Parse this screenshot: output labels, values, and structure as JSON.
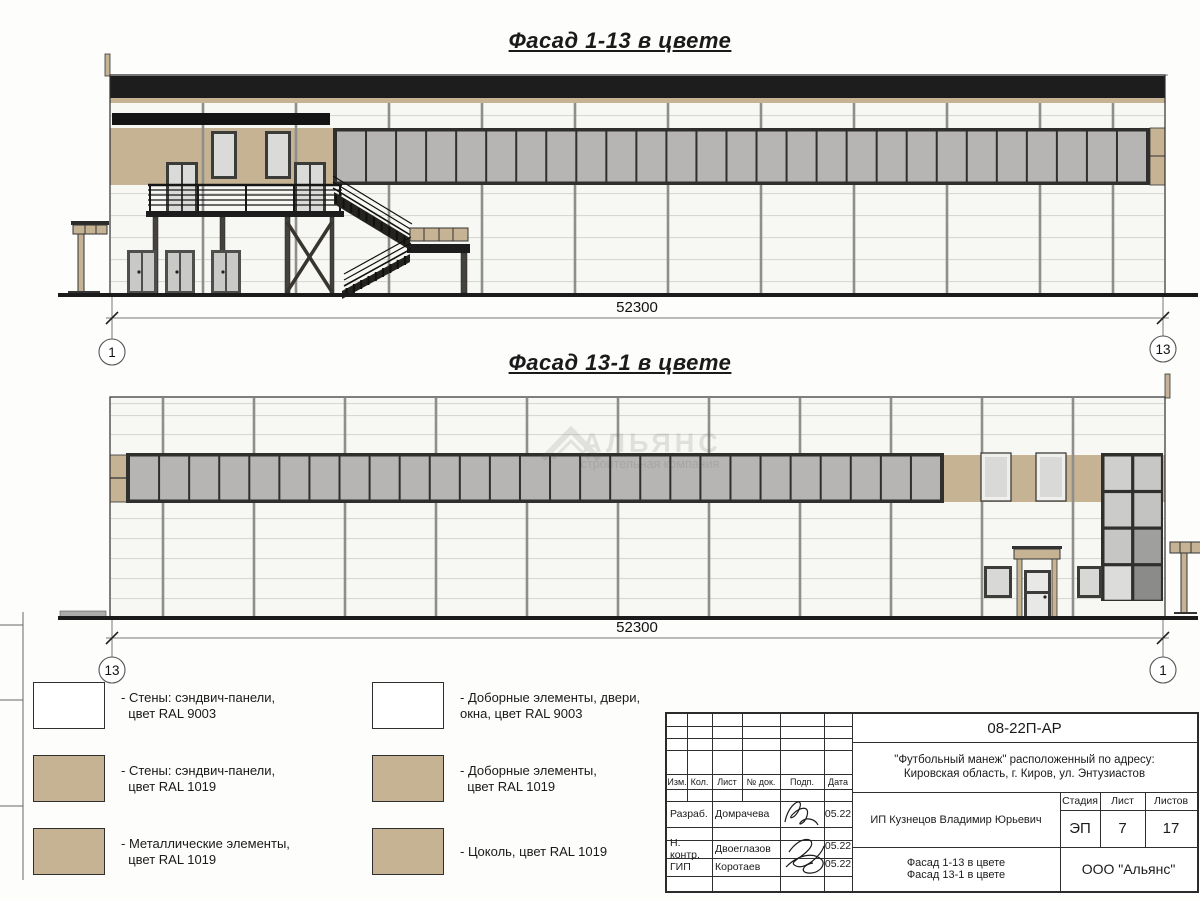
{
  "colors": {
    "tan": "#c5b394",
    "dark_band": "#1d1d1d",
    "frame": "#2f2f2d",
    "glass": "#b6b5b3",
    "panel": "#f7f7f4",
    "joint_h": "#d8d8d3",
    "joint_v": "#8f8e8a",
    "light_glass": "#dadad8",
    "grid_shades": [
      [
        "#cfcfcd",
        "#c7c7c5"
      ],
      [
        "#cbcbc9",
        "#c3c3c1"
      ],
      [
        "#c6c6c4",
        "#9f9f9d"
      ],
      [
        "#dcdcda",
        "#8b8b89"
      ]
    ]
  },
  "facade1": {
    "title": "Фасад 1-13 в цвете",
    "dimension": "52300",
    "axis_left": "1",
    "axis_right": "13",
    "ribbon_panes": 27
  },
  "facade2": {
    "title": "Фасад 13-1 в цвете",
    "dimension": "52300",
    "axis_left": "13",
    "axis_right": "1",
    "ribbon_panes": 27
  },
  "watermark": {
    "name": "АЛЬЯНС",
    "tagline": "строительная компания"
  },
  "legend": {
    "col1": [
      {
        "color": "#ffffff",
        "label": "- Стены: сэндвич-панели,\n  цвет RAL 9003"
      },
      {
        "color": "#c5b394",
        "label": "- Стены: сэндвич-панели,\n  цвет RAL 1019"
      },
      {
        "color": "#c5b394",
        "label": "- Металлические элементы,\n  цвет RAL 1019"
      }
    ],
    "col2": [
      {
        "color": "#ffffff",
        "label": "- Доборные элементы, двери,\nокна, цвет RAL 9003"
      },
      {
        "color": "#c5b394",
        "label": "- Доборные элементы,\n  цвет RAL 1019"
      },
      {
        "color": "#c5b394",
        "label": "- Цоколь, цвет RAL 1019"
      }
    ]
  },
  "title_block": {
    "doc_number": "08-22П-АР",
    "project": "\"Футбольный манеж\" расположенный по адресу:\nКировская область, г. Киров, ул. Энтузиастов",
    "client": "ИП Кузнецов Владимир Юрьевич",
    "sheet_title": "Фасад 1-13 в цвете\nФасад 13-1 в цвете",
    "company": "ООО \"Альянс\"",
    "columns": {
      "izm": "Изм.",
      "kol": "Кол.",
      "list": "Лист",
      "doc": "№ док.",
      "podp": "Подп.",
      "data": "Дата"
    },
    "stage_label": "Стадия",
    "sheet_label": "Лист",
    "sheets_label": "Листов",
    "stage": "ЭП",
    "sheet_number": "7",
    "sheets_total": "17",
    "rows": [
      {
        "role": "Разраб.",
        "name": "Домрачева",
        "date": "05.22"
      },
      {
        "role": "Н. контр.",
        "name": "Двоеглазов",
        "date": "05.22"
      },
      {
        "role": "ГИП",
        "name": "Коротаев",
        "date": "05.22"
      }
    ]
  }
}
